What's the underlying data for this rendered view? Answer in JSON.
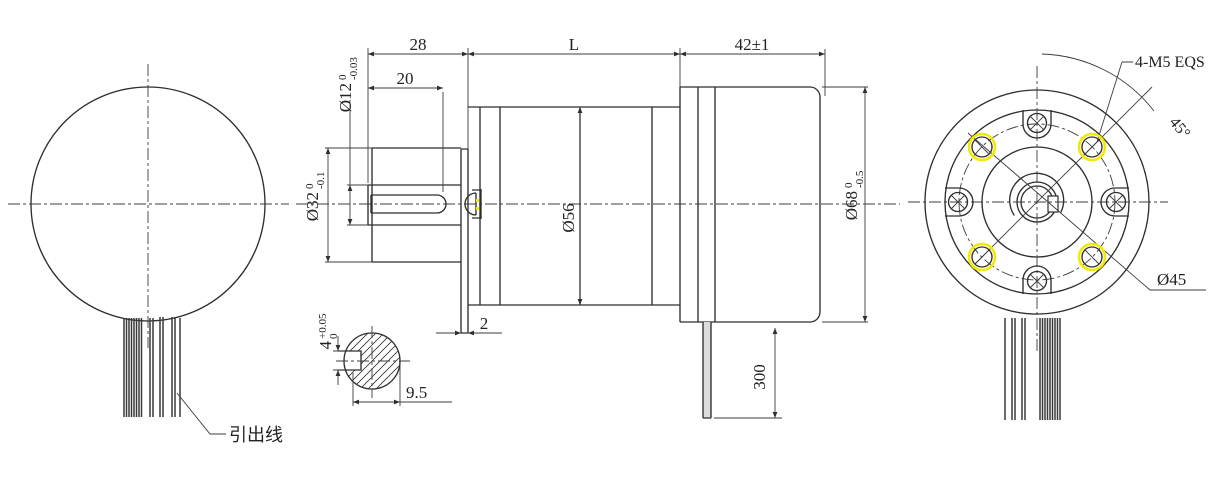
{
  "drawing": {
    "labels": {
      "len_keyway": "20",
      "len_shaft": "28",
      "len_gearbox": "L",
      "len_motor": "42±1",
      "dia_shaft": "Ø12",
      "dia_shaft_tol_up": "0",
      "dia_shaft_tol_dn": "-0.03",
      "dia_boss": "Ø32",
      "dia_boss_tol_up": "0",
      "dia_boss_tol_dn": "-0.1",
      "dia_gearbox": "Ø56",
      "dia_motor": "Ø68",
      "dia_motor_tol_up": "0",
      "dia_motor_tol_dn": "-0.5",
      "flange_thickness": "2",
      "wire_length": "300",
      "key_width": "4",
      "key_width_tol_up": "+0.05",
      "key_width_tol_dn": "0",
      "key_flat": "9.5",
      "lead_wire": "引出线",
      "bolt_callout": "4-M5 EQS",
      "bolt_angle": "45°",
      "dia_bolt_circle": "Ø45"
    },
    "colors": {
      "line": "#2f2f2f",
      "highlight_yellow": "#f2ea00",
      "background": "#ffffff"
    }
  }
}
